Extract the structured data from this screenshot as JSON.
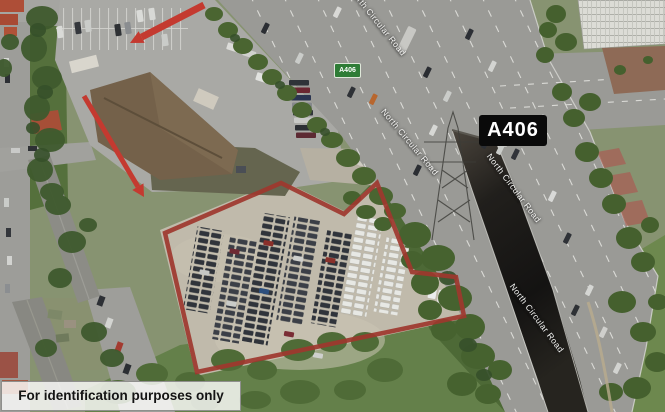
{
  "labels": {
    "caption": "For identification purposes only",
    "route_badge": "A406",
    "slip_badge": "A406",
    "road_names": [
      {
        "text": "North Circular Road"
      },
      {
        "text": "North Circular Road"
      },
      {
        "text": "North Circular Road"
      },
      {
        "text": "North Circular Road"
      }
    ]
  },
  "colors": {
    "annotation_red": "#b23a30",
    "route_badge_bg": "#0a0a0a",
    "slip_badge_bg": "#2e7c36",
    "caption_bg": "#ffffff"
  }
}
